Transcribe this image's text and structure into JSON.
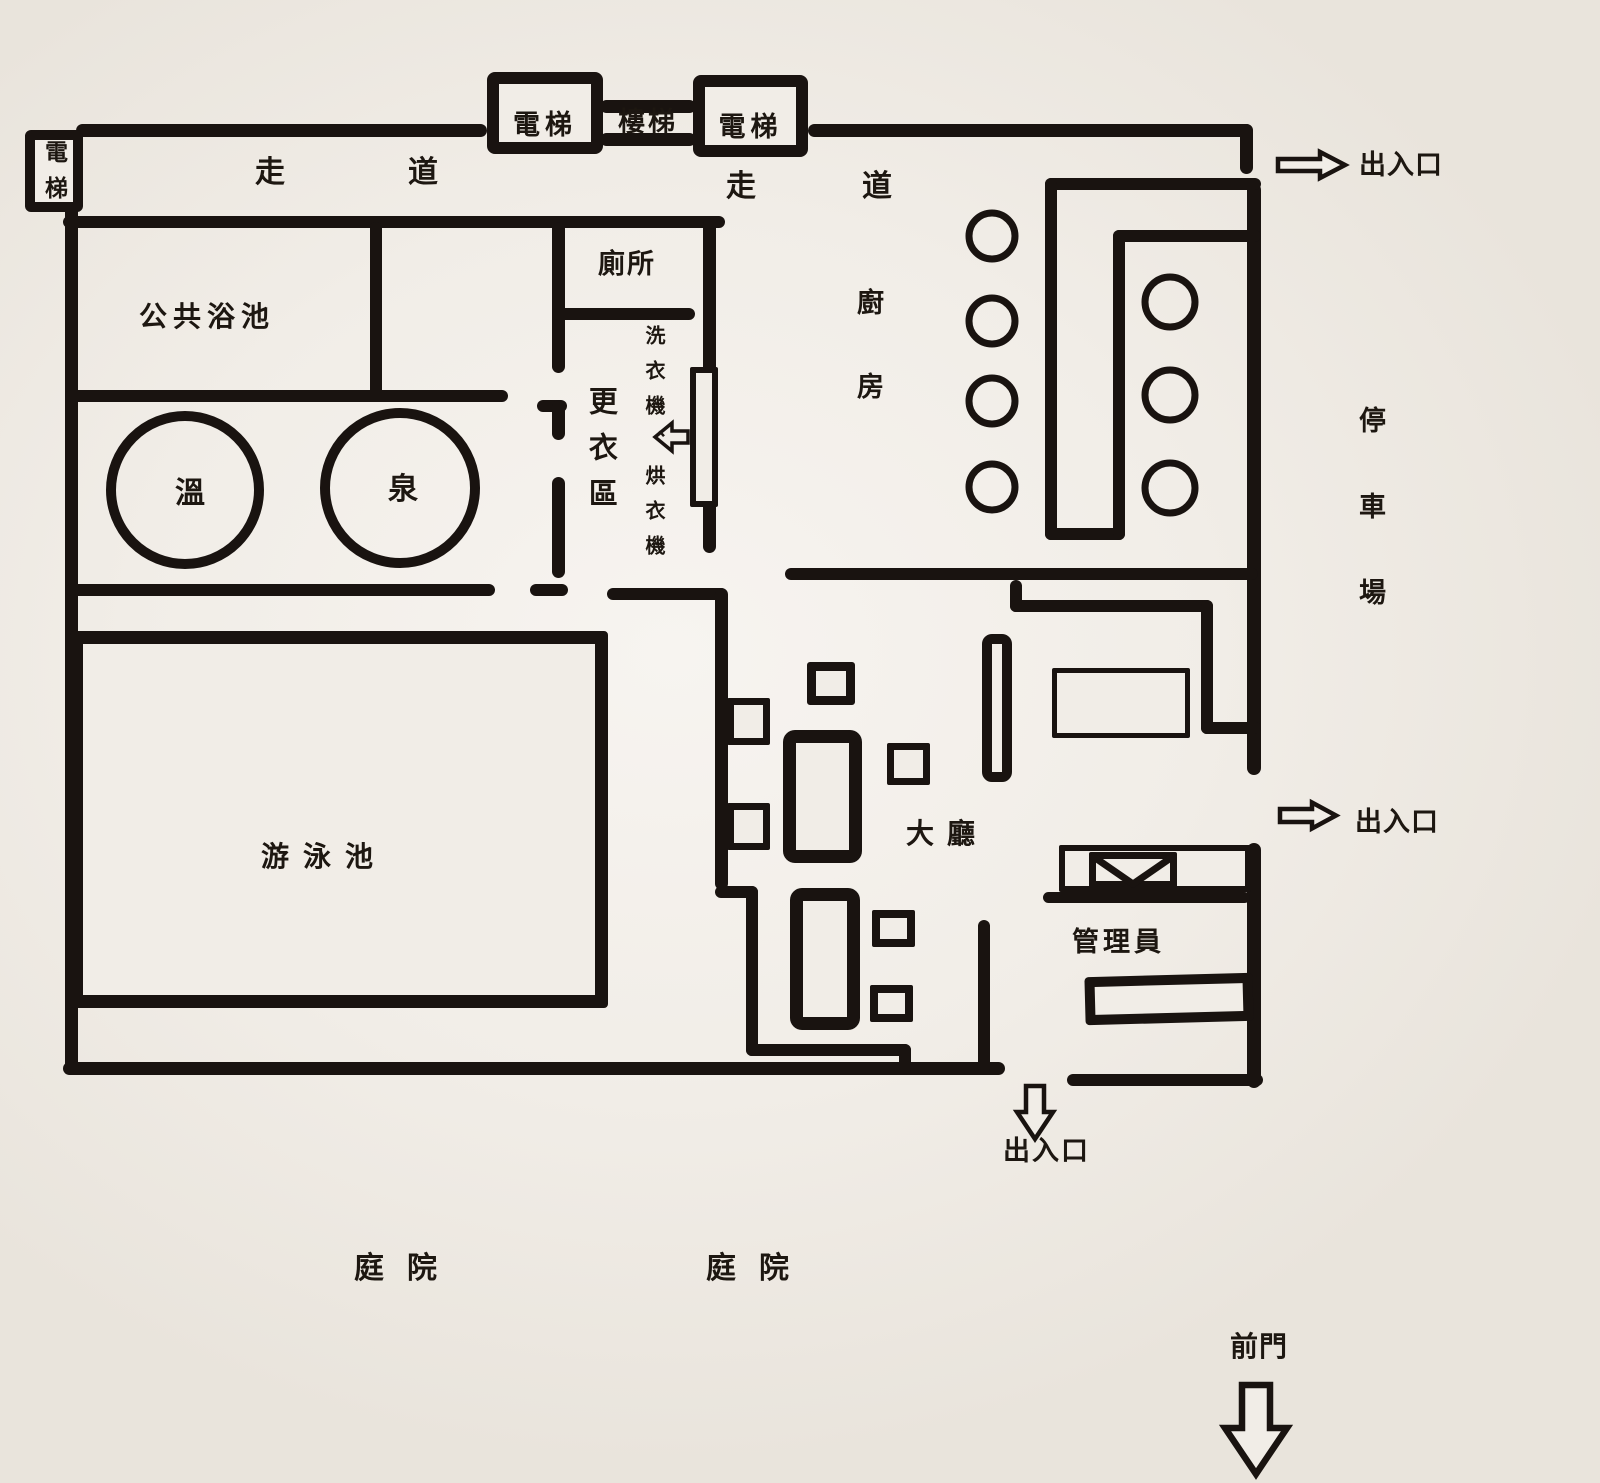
{
  "title": "hot-spring-facility-floor-plan",
  "colors": {
    "background": "#f1ede7",
    "wall": "#191310",
    "text": "#1d1711"
  },
  "labels": {
    "elevator_west": "電梯",
    "elevator_top_left": "電梯",
    "elevator_top_right": "電梯",
    "stairs": "樓梯",
    "corridor_west": "走道",
    "corridor_east": "走道",
    "public_bath": "公共浴池",
    "toilet": "廁所",
    "hot": "溫",
    "spring": "泉",
    "changing_area": "更衣區",
    "laundry": "洗衣機、烘衣機",
    "kitchen": "廚房",
    "parking": "停車場",
    "pool": "游泳池",
    "lobby": "大廳",
    "manager": "管理員",
    "exit_top": "出入口",
    "exit_right": "出入口",
    "exit_bottom": "出入口",
    "courtyard_west": "庭院",
    "courtyard_east": "庭院",
    "front_gate": "前門"
  },
  "icons": {
    "exit_top": "arrow-right-icon",
    "exit_right": "arrow-right-icon",
    "exit_bottom": "arrow-down-icon",
    "laundry_pointer": "arrow-left-icon",
    "front_gate": "arrow-down-icon",
    "reception_desk": "envelope-icon",
    "hot_spring_pools": "circle-icon",
    "kitchen_burners": "circle-icon"
  }
}
